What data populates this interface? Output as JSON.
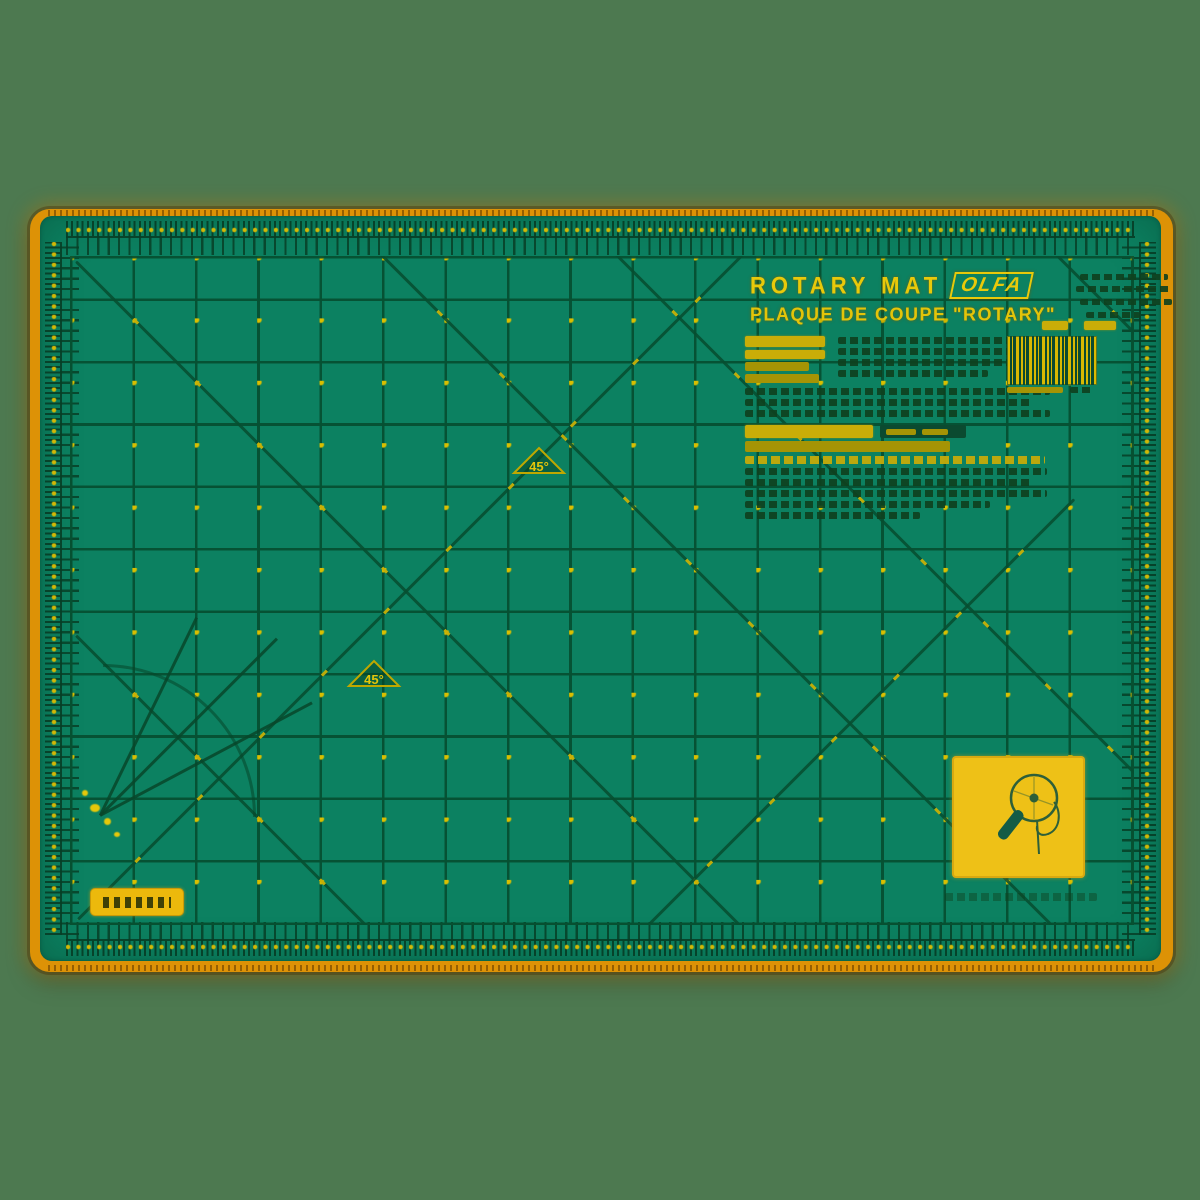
{
  "scene": {
    "background_color": "#4d7950"
  },
  "mat": {
    "rim_color": "#dd9206",
    "surface_color": "#0c8161",
    "grid_line_color": "#065032",
    "accent_color": "#d9bf00",
    "header": {
      "title": "ROTARY MAT",
      "brand": "OLFA",
      "subtitle": "PLAQUE DE COUPE \"ROTARY\""
    },
    "angle_marker_label": "45°",
    "grid": {
      "columns": 17,
      "rows": 11
    },
    "label_panel": {
      "background_color": "#eec117",
      "icon": "rotary-cutter-icon"
    }
  }
}
